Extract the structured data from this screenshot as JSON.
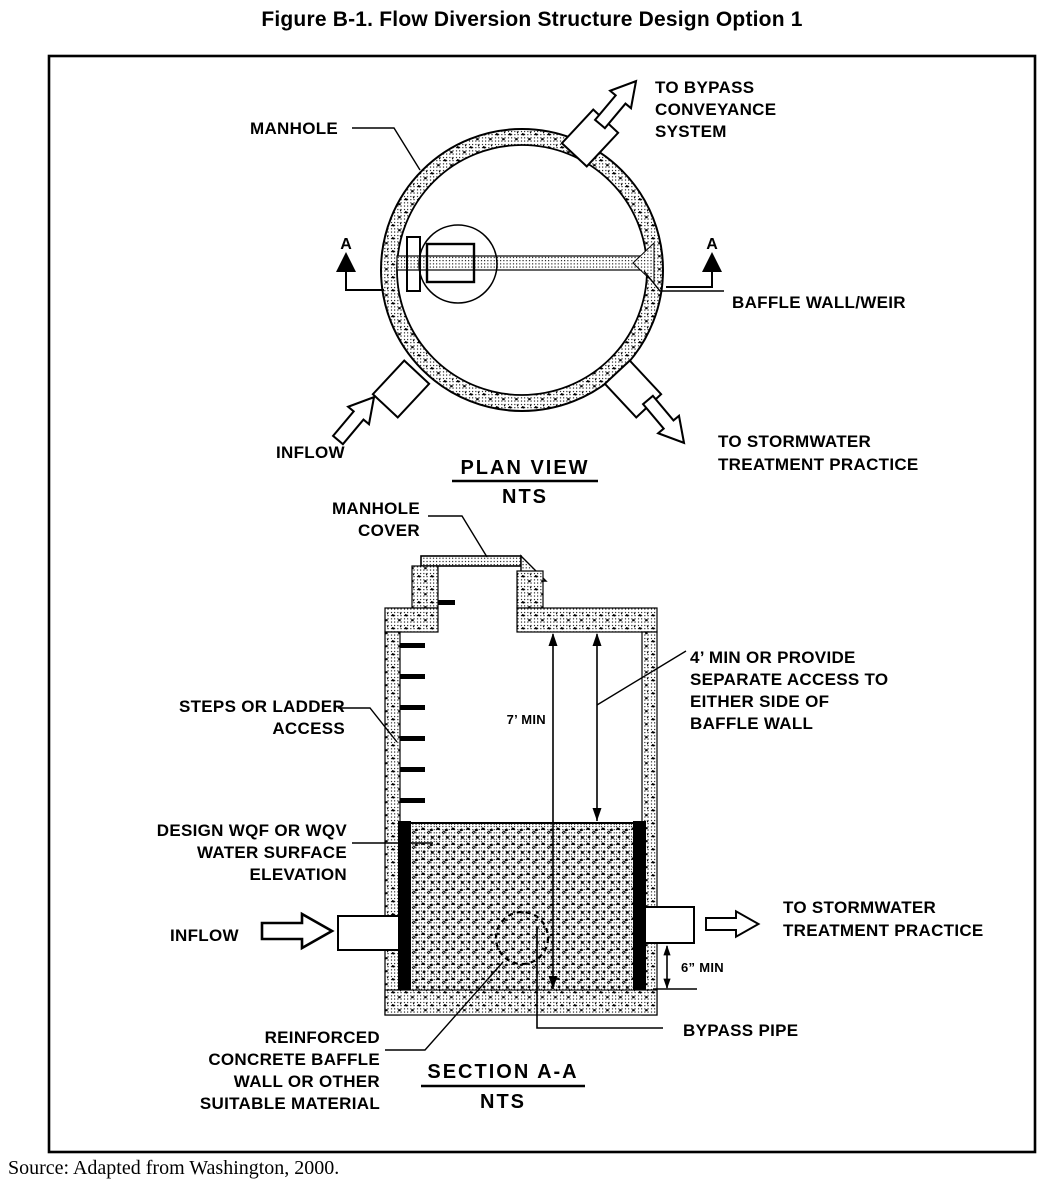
{
  "figure": {
    "title": "Figure B-1. Flow Diversion Structure Design Option 1",
    "source": "Source: Adapted from Washington, 2000."
  },
  "plan": {
    "caption": "PLAN VIEW",
    "scale": "NTS",
    "marker": "A",
    "manhole": "MANHOLE",
    "to_bypass": [
      "TO BYPASS",
      "CONVEYANCE",
      "SYSTEM"
    ],
    "baffle": "BAFFLE WALL/WEIR",
    "inflow": "INFLOW",
    "to_stormwater": [
      "TO STORMWATER",
      "TREATMENT PRACTICE"
    ]
  },
  "section": {
    "caption": "SECTION A-A",
    "scale": "NTS",
    "manhole_cover": [
      "MANHOLE",
      "COVER"
    ],
    "steps": [
      "STEPS OR LADDER",
      "ACCESS"
    ],
    "wq_elevation": [
      "DESIGN WQF OR WQV",
      "WATER SURFACE",
      "ELEVATION"
    ],
    "inflow": "INFLOW",
    "access_note": [
      "4’ MIN OR PROVIDE",
      "SEPARATE ACCESS TO",
      "EITHER SIDE OF",
      "BAFFLE WALL"
    ],
    "to_stormwater": [
      "TO STORMWATER",
      "TREATMENT PRACTICE"
    ],
    "reinforced": [
      "REINFORCED",
      "CONCRETE BAFFLE",
      "WALL OR OTHER",
      "SUITABLE MATERIAL"
    ],
    "bypass": "BYPASS PIPE",
    "dim_depth": "7’ MIN",
    "dim_clearance": "6” MIN"
  },
  "colors": {
    "ink": "#000000",
    "paper": "#ffffff"
  }
}
